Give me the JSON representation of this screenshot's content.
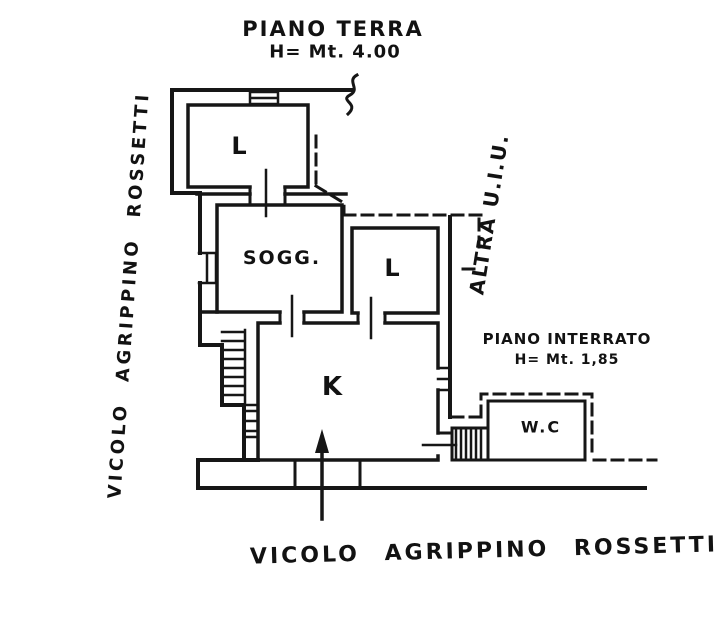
{
  "drawing": {
    "ink_color": "#161616",
    "paper_color": "#ffffff",
    "captions": {
      "ground_floor": {
        "line1": "PIANO TERRA",
        "line2": "H= Mt. 4.00"
      },
      "basement": {
        "line1": "PIANO INTERRATO",
        "line2": "H= Mt. 1,85"
      }
    },
    "streets": {
      "left": "VICOLO AGRIPPINO ROSSETTI",
      "bottom": "VICOLO AGRIPPINO ROSSETTI"
    },
    "adjacent_unit": "ALTRA U.I.U.",
    "rooms": [
      {
        "label": "L"
      },
      {
        "label": "SOGG."
      },
      {
        "label": "L"
      },
      {
        "label": "K"
      },
      {
        "label": "W.C"
      }
    ]
  }
}
